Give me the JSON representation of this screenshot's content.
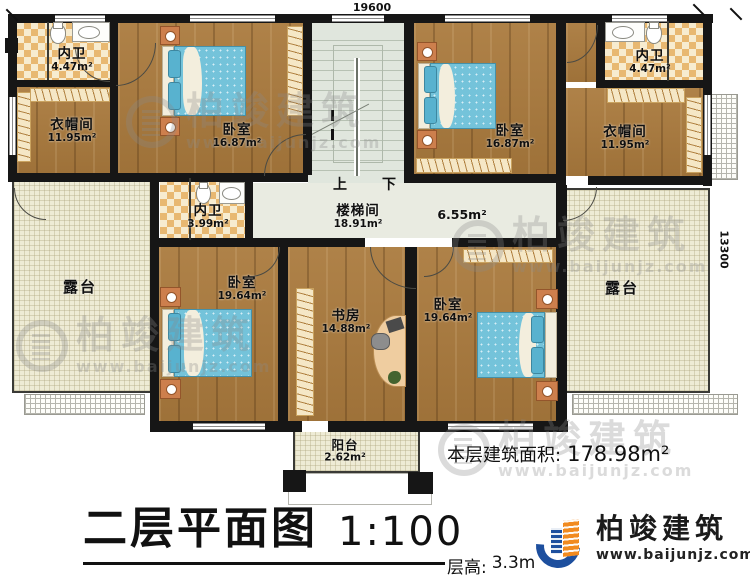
{
  "dimensions": {
    "width_mm": "19600",
    "height_mm": "13300"
  },
  "rooms": {
    "bath_tl": {
      "name": "内卫",
      "area": "4.47m²"
    },
    "cloak_l": {
      "name": "衣帽间",
      "area": "11.95m²"
    },
    "bed_1": {
      "name": "卧室",
      "area": "16.87m²"
    },
    "stairwell": {
      "name": "楼梯间",
      "area": "18.91m²"
    },
    "bed_2": {
      "name": "卧室",
      "area": "16.87m²"
    },
    "bath_tr": {
      "name": "内卫",
      "area": "4.47m²"
    },
    "cloak_r": {
      "name": "衣帽间",
      "area": "11.95m²"
    },
    "bath_mid": {
      "name": "内卫",
      "area": "3.99m²"
    },
    "hall": {
      "area": "6.55m²"
    },
    "terrace_l": {
      "name": "露台"
    },
    "terrace_r": {
      "name": "露台"
    },
    "bed_3": {
      "name": "卧室",
      "area": "19.64m²"
    },
    "study": {
      "name": "书房",
      "area": "14.88m²"
    },
    "bed_4": {
      "name": "卧室",
      "area": "19.64m²"
    },
    "balcony": {
      "name": "阳台",
      "area": "2.62m²"
    }
  },
  "stairs": {
    "up": "上",
    "down": "下"
  },
  "footer": {
    "area_label": "本层建筑面积:",
    "area_value": "178.98m²",
    "title": "二层平面图",
    "scale": "1:100",
    "floor_height_label": "层高:",
    "floor_height_value": "3.3m"
  },
  "brand": {
    "name": "柏竣建筑",
    "url": "www.baijunjz.com"
  },
  "watermark": {
    "name": "柏竣建筑",
    "url": "www.baijunjz.com"
  },
  "colors": {
    "wall": "#161616",
    "wood": "#aa7a3d",
    "tile_accent": "#e8b871",
    "stair_floor": "#e0e6dd",
    "terrace": "#eeebd5",
    "bed_blue": "#74c3da",
    "brand_blue": "#1d4f9e",
    "brand_orange": "#f18a1f"
  }
}
